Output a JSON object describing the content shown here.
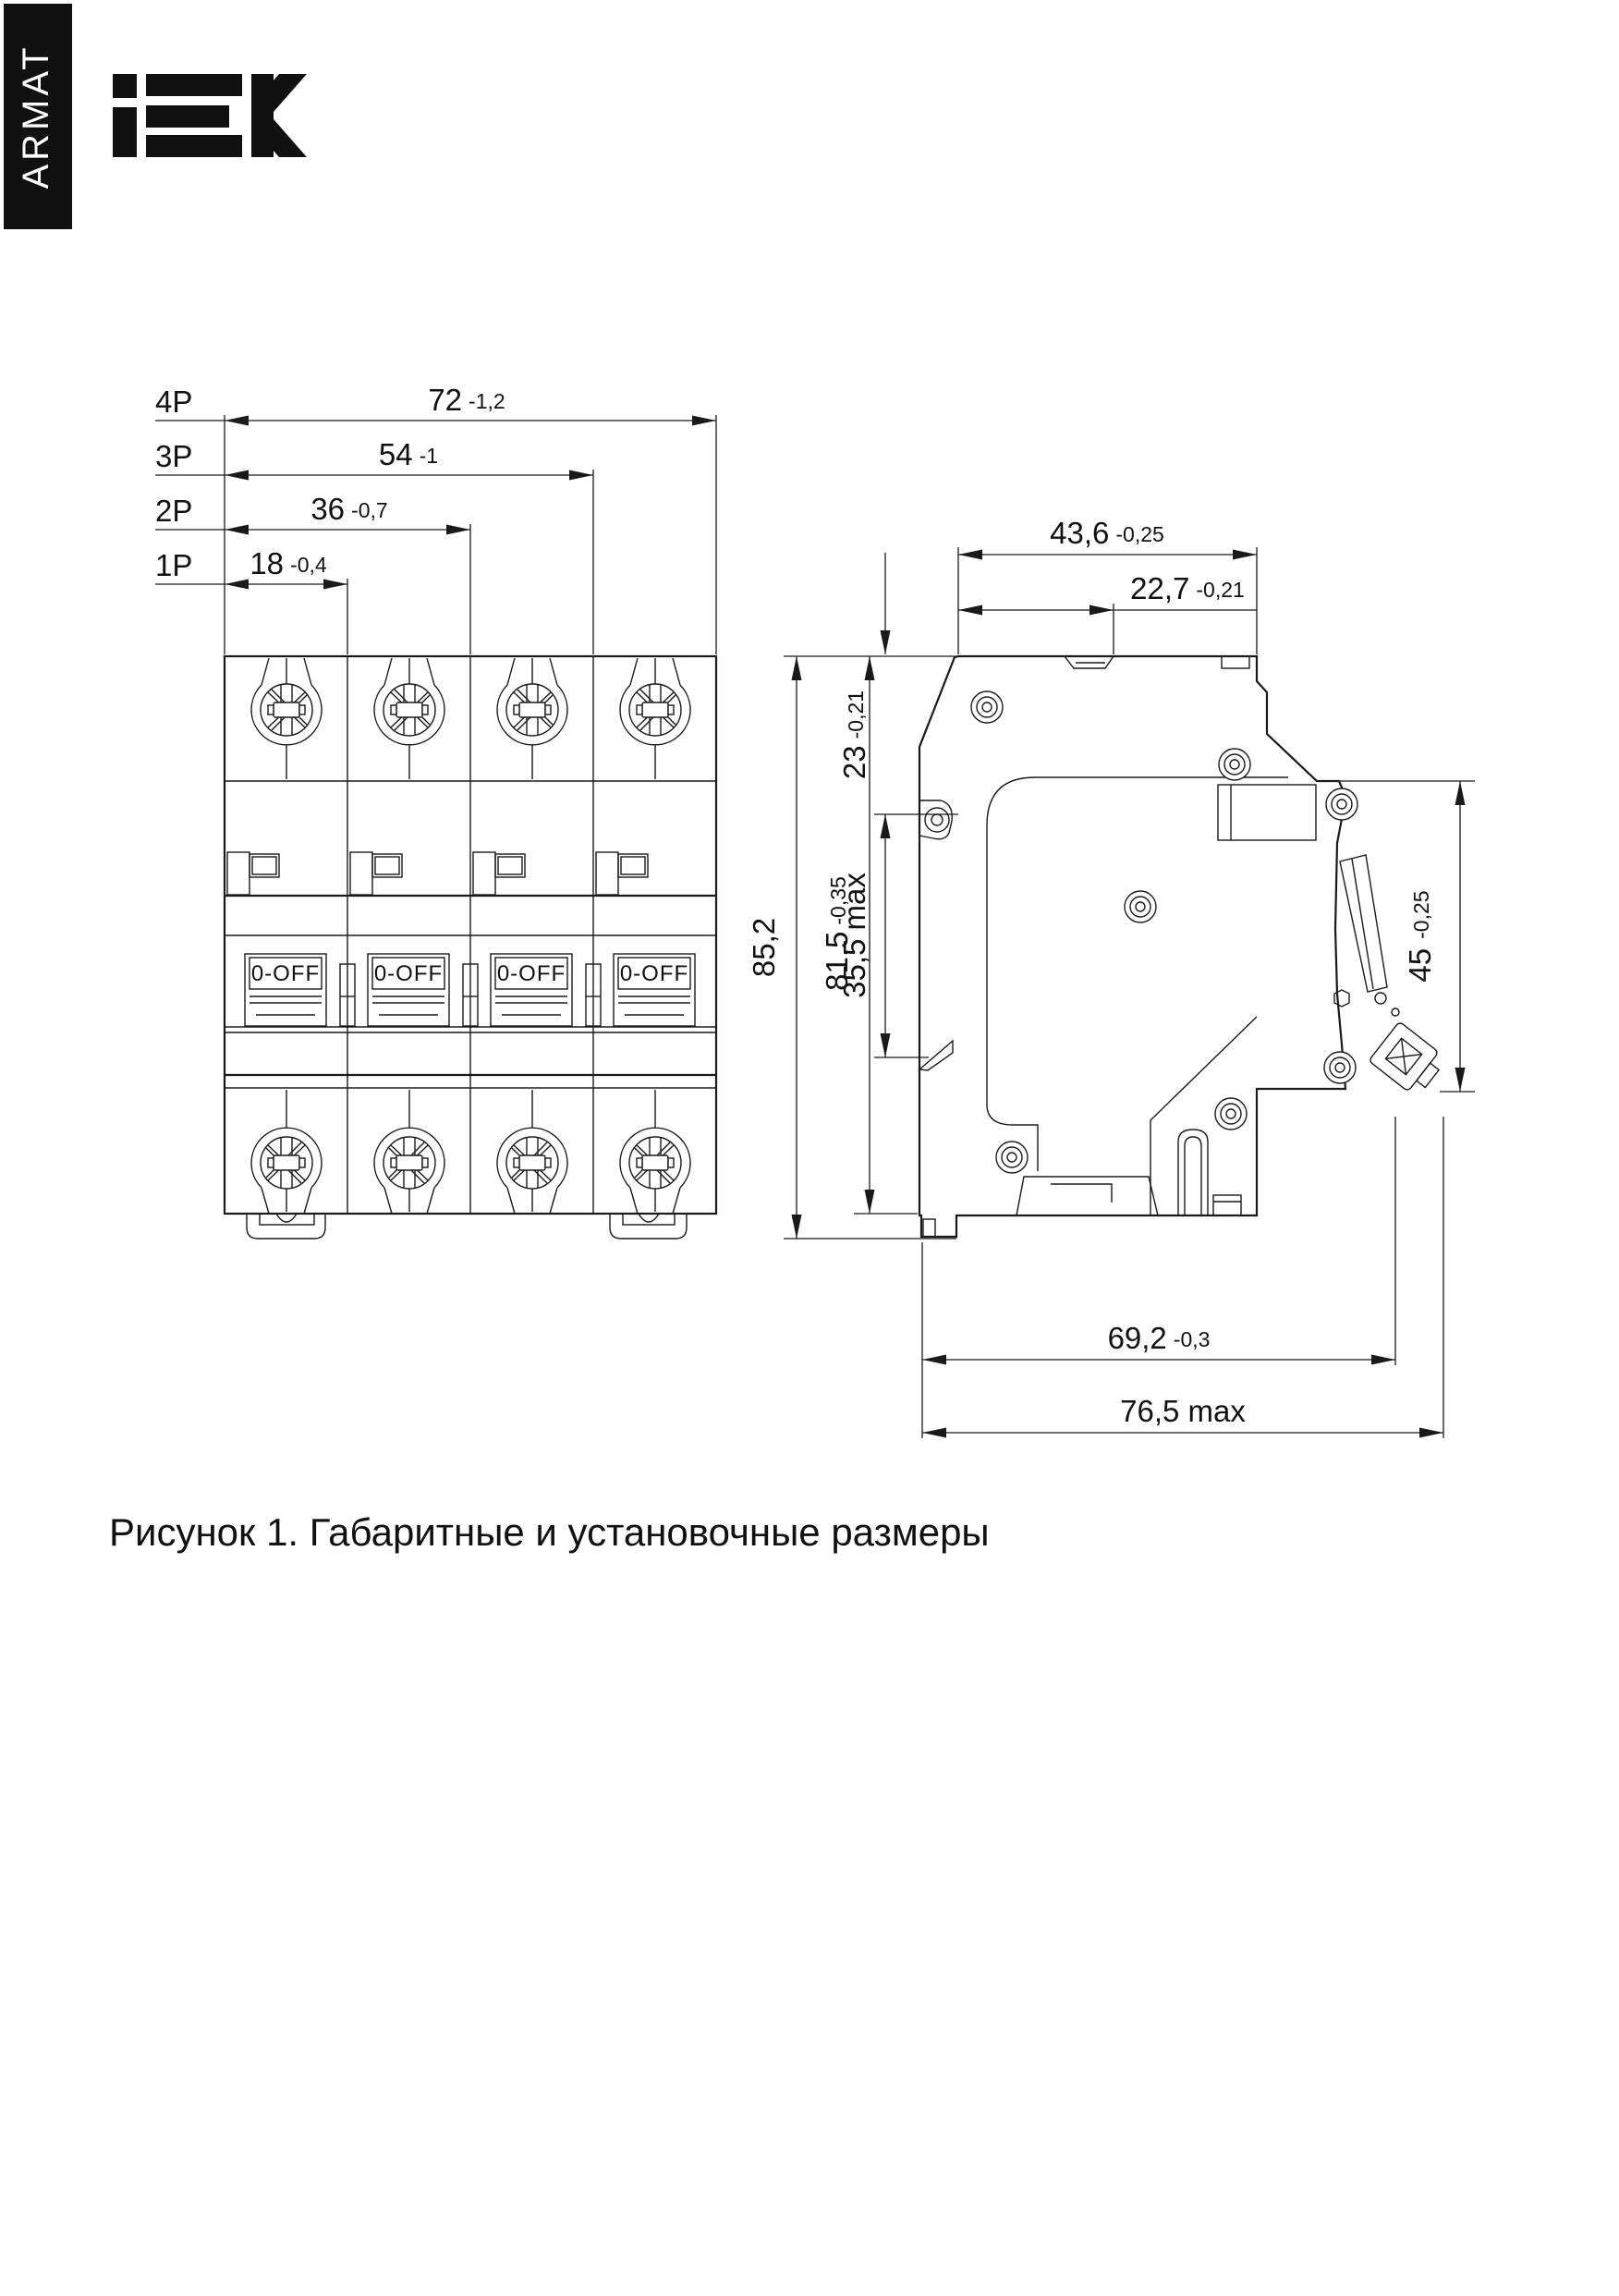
{
  "page": {
    "background": "#ffffff",
    "line_color": "#1a1a1a",
    "banner_color": "#111111"
  },
  "header": {
    "series_label": "ARMAT",
    "brand": "IEK"
  },
  "front_view": {
    "width_dims": [
      {
        "poles": "4P",
        "value": "72",
        "tolerance": "-1,2"
      },
      {
        "poles": "3P",
        "value": "54",
        "tolerance": "-1"
      },
      {
        "poles": "2P",
        "value": "36",
        "tolerance": "-0,7"
      },
      {
        "poles": "1P",
        "value": "18",
        "tolerance": "-0,4"
      }
    ],
    "toggle_label": "0-OFF"
  },
  "side_view": {
    "top_width": {
      "value": "43,6",
      "tolerance": "-0,25"
    },
    "top_front_offset": {
      "value": "22,7",
      "tolerance": "-0,21"
    },
    "latch_offset": {
      "value": "23",
      "tolerance": "-0,21"
    },
    "latch_travel": {
      "value": "35,5",
      "suffix": " max"
    },
    "overall_height": {
      "value": "85,2"
    },
    "body_height": {
      "value": "81,5",
      "tolerance": "-0,35"
    },
    "front_height": {
      "value": "45",
      "tolerance": "-0,25"
    },
    "depth": {
      "value": "69,2",
      "tolerance": "-0,3"
    },
    "max_depth": {
      "value": "76,5",
      "suffix": " max"
    }
  },
  "caption": "Рисунок 1. Габаритные и установочные размеры"
}
